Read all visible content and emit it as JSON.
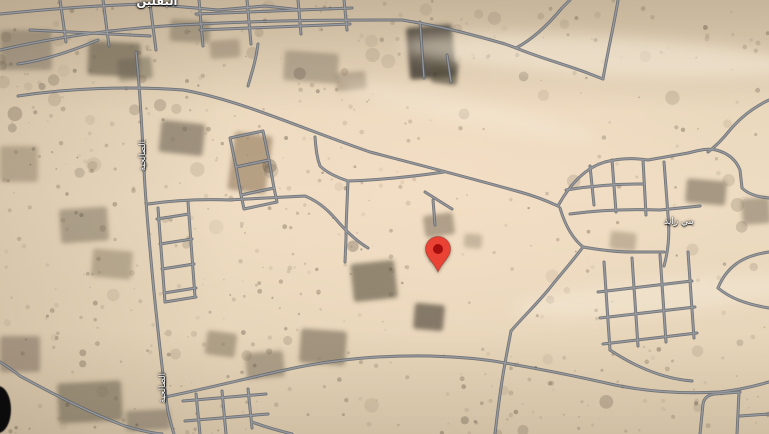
{
  "map": {
    "view_type": "satellite",
    "labels": [
      {
        "id": "town-top",
        "text": "البقلين"
      },
      {
        "id": "district",
        "text": "بني زايد"
      },
      {
        "id": "road-left",
        "text": "الصالحية"
      },
      {
        "id": "road-left-lower",
        "text": "الصالحية"
      }
    ],
    "marker": {
      "x": 438,
      "y": 272,
      "body_color": "#EA4335",
      "dot_color": "#A50E0E"
    },
    "colors": {
      "terrain": "#EADAC0",
      "road_casing": "#5B6067",
      "road_core": "#989CA3"
    }
  }
}
